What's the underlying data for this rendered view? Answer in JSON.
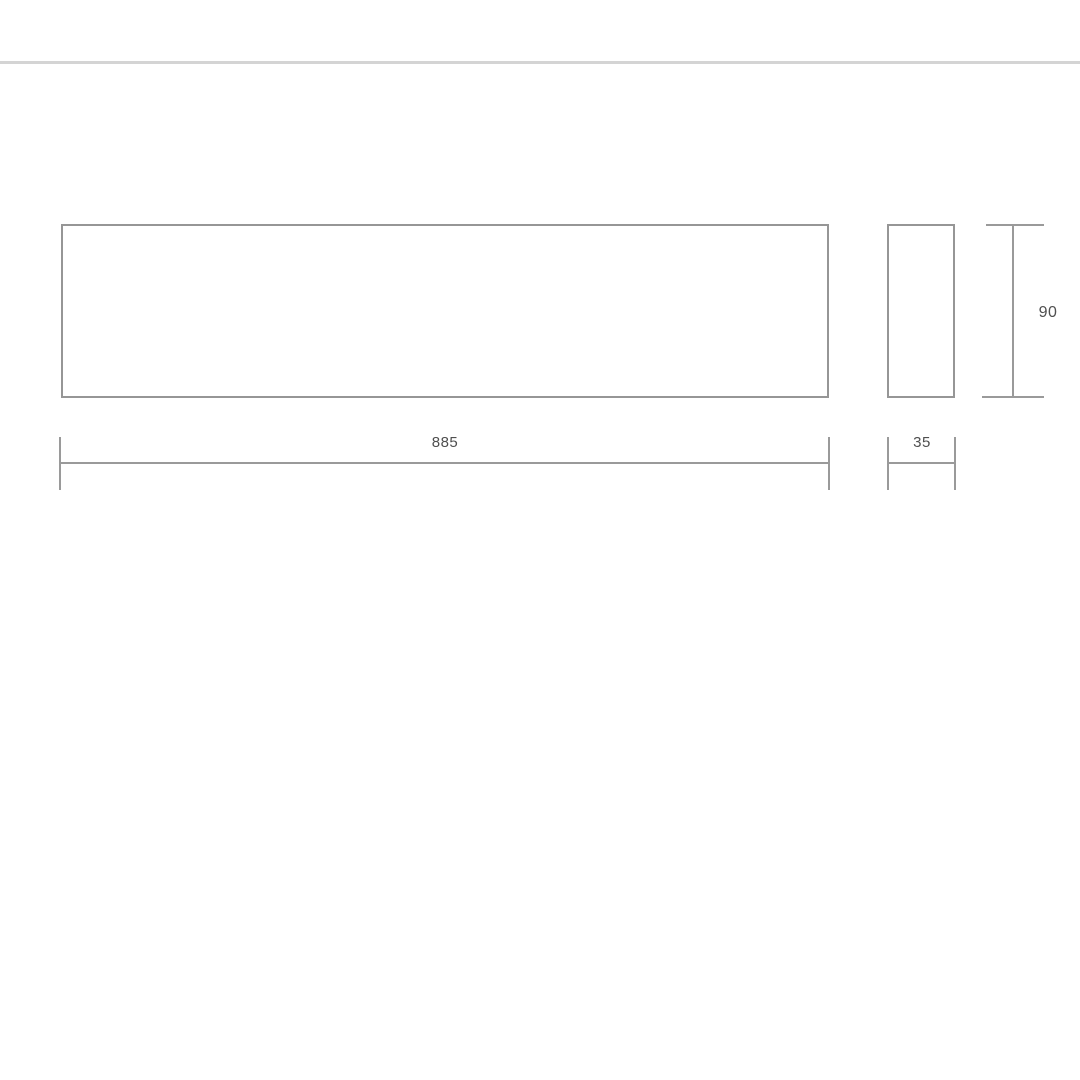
{
  "diagram": {
    "type": "technical-dimension-drawing",
    "views": {
      "front": "front-view-outline",
      "side": "side-view-outline"
    },
    "dimensions": {
      "width": "885",
      "depth": "35",
      "height": "90"
    },
    "colors": {
      "outline": "#969696",
      "dimension_line": "#9a9a9a",
      "label_text": "#4f4f4f",
      "divider": "#d4d4d4",
      "background": "#ffffff"
    }
  }
}
